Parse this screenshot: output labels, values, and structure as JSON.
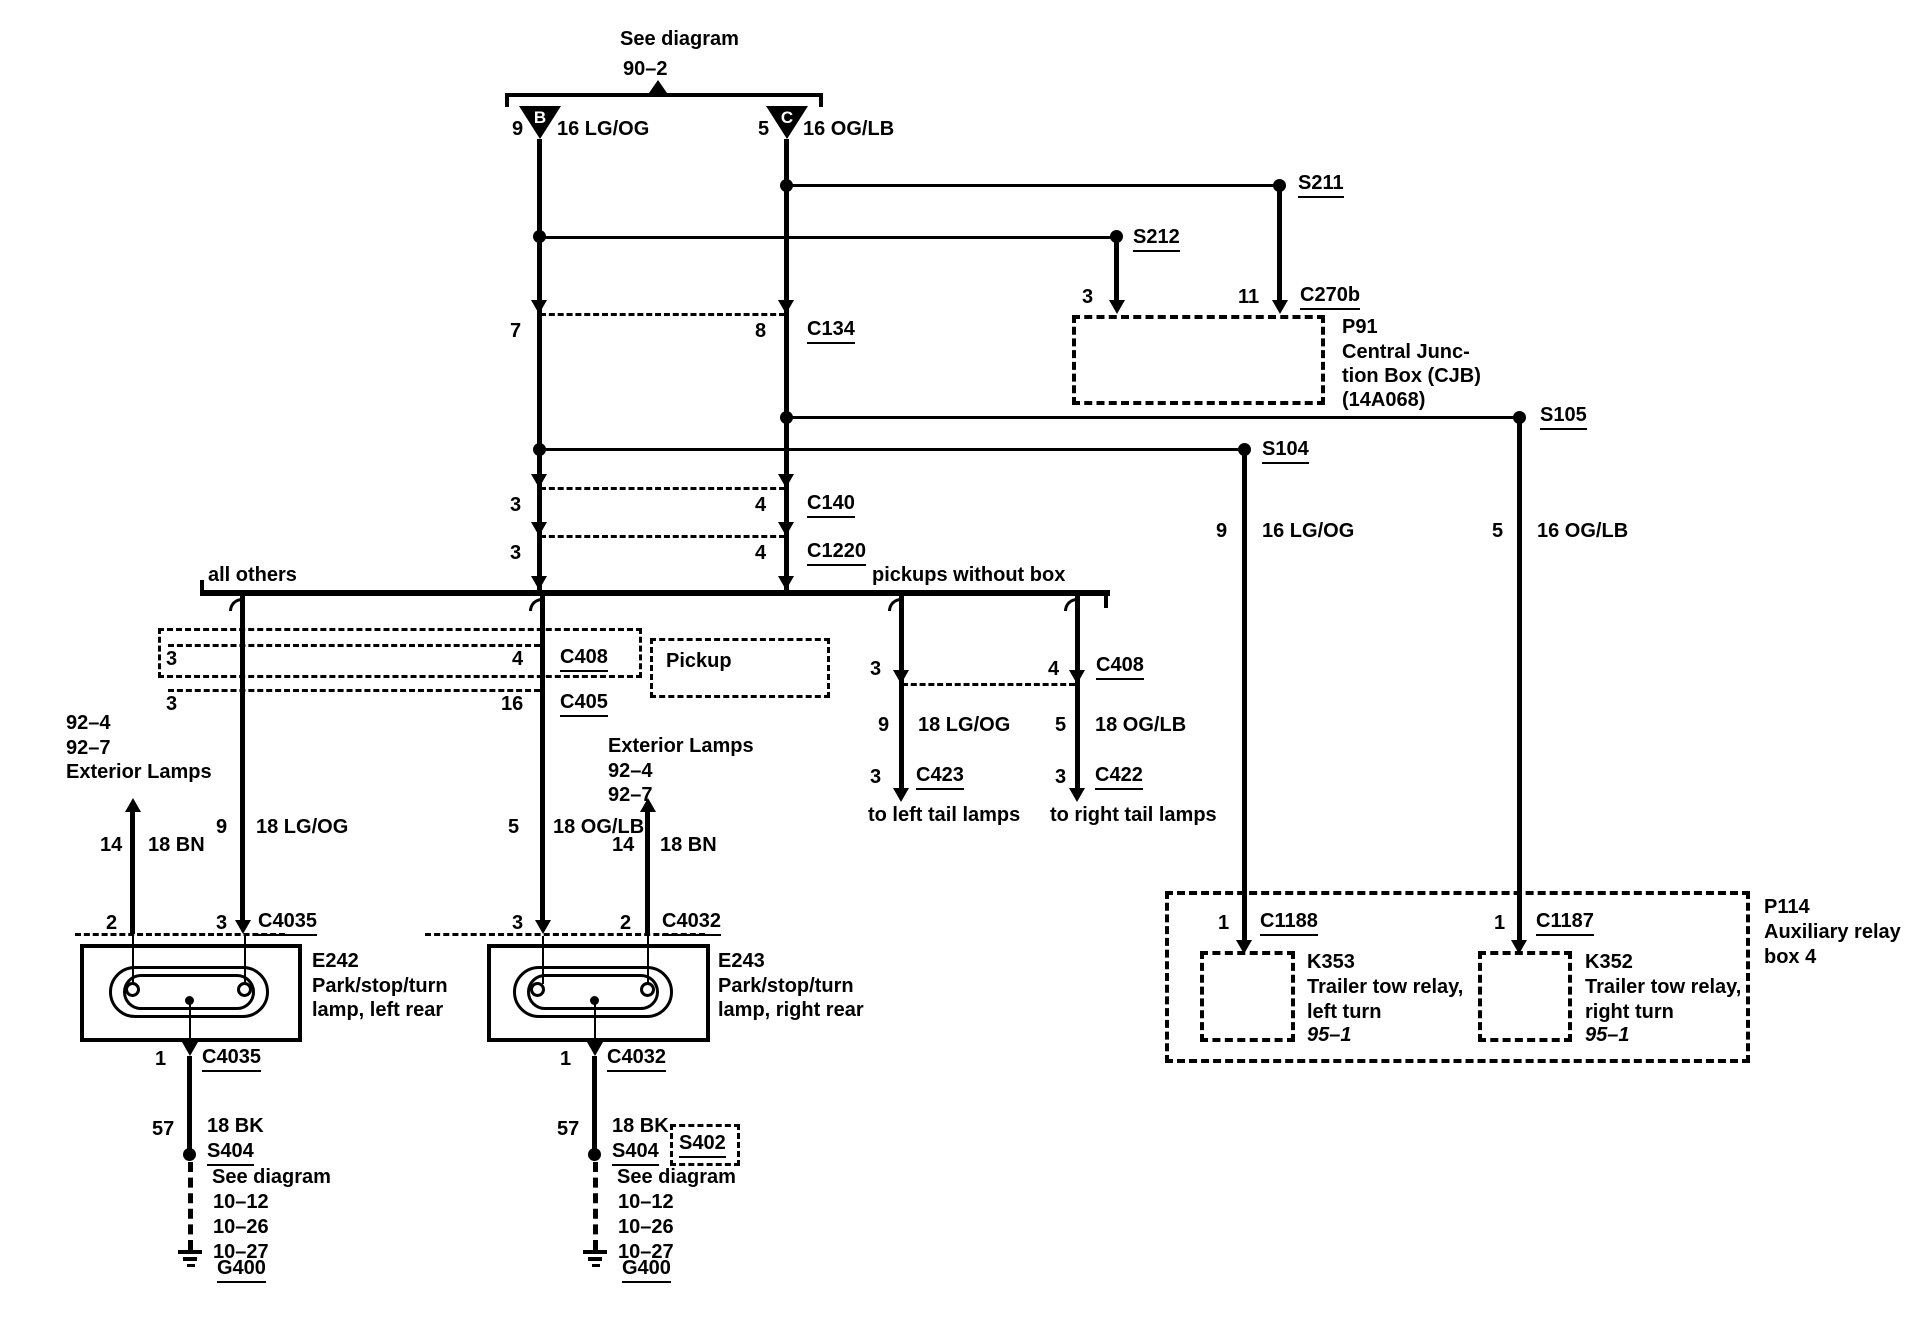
{
  "colors": {
    "ink": "#000000",
    "paper": "#ffffff"
  },
  "top": {
    "note_line1": "See diagram",
    "note_line2": "90–2",
    "conn_b": "B",
    "conn_c": "C",
    "wire_b": {
      "pin": "9",
      "gauge": "16 LG/OG"
    },
    "wire_c": {
      "pin": "5",
      "gauge": "16 OG/LB"
    }
  },
  "splices": {
    "s211": "S211",
    "s212": "S212",
    "s104": "S104",
    "s105": "S105"
  },
  "cjb": {
    "pin_left": "3",
    "pin_right": "11",
    "connector": "C270b",
    "id": "P91",
    "name_line1": "Central Junc-",
    "name_line2": "tion Box (CJB)",
    "name_line3": "(14A068)"
  },
  "inline_connectors": {
    "c134": {
      "left_pin": "7",
      "right_pin": "8",
      "label": "C134"
    },
    "c140": {
      "left_pin": "3",
      "right_pin": "4",
      "label": "C140"
    },
    "c1220": {
      "left_pin": "3",
      "right_pin": "4",
      "label": "C1220"
    }
  },
  "feed_wires": {
    "left": {
      "pin": "9",
      "gauge": "16 LG/OG"
    },
    "right": {
      "pin": "5",
      "gauge": "16 OG/LB"
    }
  },
  "bus": {
    "left_label": "all others",
    "right_label": "pickups without box"
  },
  "body_connectors": {
    "c408": {
      "left_pin": "3",
      "right_pin": "4",
      "label": "C408"
    },
    "c405": {
      "left_pin": "3",
      "right_pin": "16",
      "label": "C405"
    },
    "pickup_note": "Pickup"
  },
  "left_lamp": {
    "refs": {
      "line1": "92–4",
      "line2": "92–7",
      "line3": "Exterior Lamps"
    },
    "bn_wire": {
      "pin": "14",
      "gauge": "18 BN"
    },
    "feed_wire": {
      "pin": "9",
      "gauge": "18 LG/OG"
    },
    "conn_top": {
      "left_pin": "2",
      "right_pin": "3",
      "label": "C4035"
    },
    "id": "E242",
    "name_line1": "Park/stop/turn",
    "name_line2": "lamp, left rear",
    "conn_bottom": {
      "pin": "1",
      "label": "C4035"
    },
    "gnd_wire": {
      "pin": "57",
      "gauge": "18 BK"
    },
    "splice": "S404",
    "see_note": {
      "line1": "See diagram",
      "line2": "10–12",
      "line3": "10–26",
      "line4": "10–27"
    },
    "ground": "G400"
  },
  "right_lamp": {
    "refs": {
      "line1": "Exterior Lamps",
      "line2": "92–4",
      "line3": "92–7"
    },
    "feed_wire": {
      "pin": "5",
      "gauge": "18 OG/LB"
    },
    "bn_wire": {
      "pin": "14",
      "gauge": "18 BN"
    },
    "conn_top": {
      "left_pin": "3",
      "right_pin": "2",
      "label": "C4032"
    },
    "id": "E243",
    "name_line1": "Park/stop/turn",
    "name_line2": "lamp, right rear",
    "conn_bottom": {
      "pin": "1",
      "label": "C4032"
    },
    "gnd_wire": {
      "pin": "57",
      "gauge": "18 BK"
    },
    "splice": "S404",
    "splice2": "S402",
    "see_note": {
      "line1": "See diagram",
      "line2": "10–12",
      "line3": "10–26",
      "line4": "10–27"
    },
    "ground": "G400"
  },
  "pickups": {
    "c408": {
      "left_pin": "3",
      "right_pin": "4",
      "label": "C408"
    },
    "left_wire": {
      "pin": "9",
      "gauge": "18 LG/OG"
    },
    "right_wire": {
      "pin": "5",
      "gauge": "18 OG/LB"
    },
    "c423": {
      "pin": "3",
      "label": "C423"
    },
    "c422": {
      "pin": "3",
      "label": "C422"
    },
    "left_dest": "to left tail lamps",
    "right_dest": "to right tail lamps"
  },
  "relay_box": {
    "id": "P114",
    "name_line1": "Auxiliary relay",
    "name_line2": "box 4",
    "c1188": {
      "pin": "1",
      "label": "C1188"
    },
    "c1187": {
      "pin": "1",
      "label": "C1187"
    },
    "k353": {
      "id": "K353",
      "name_line1": "Trailer tow relay,",
      "name_line2": "left turn",
      "ref": "95–1"
    },
    "k352": {
      "id": "K352",
      "name_line1": "Trailer tow relay,",
      "name_line2": "right turn",
      "ref": "95–1"
    }
  }
}
